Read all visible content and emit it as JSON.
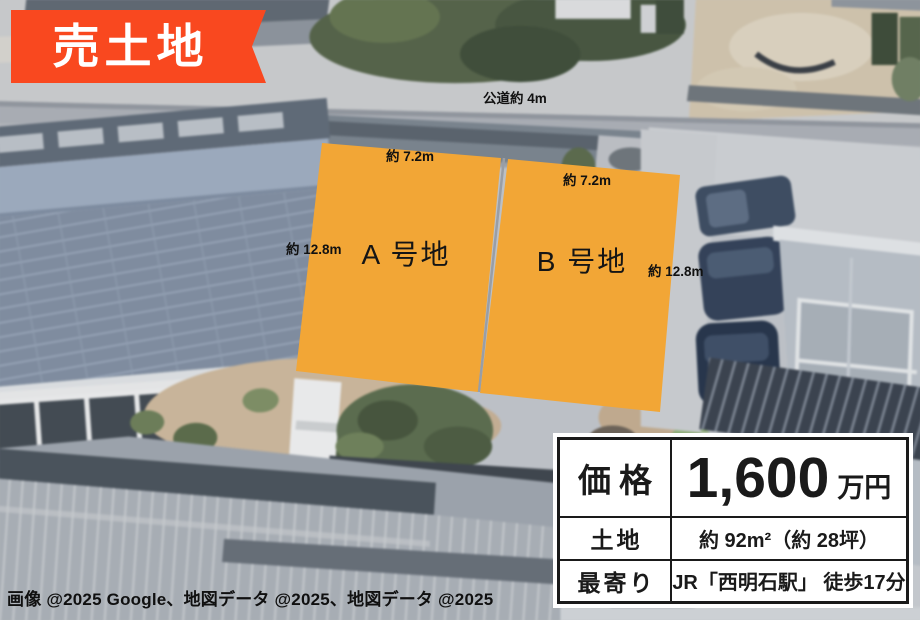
{
  "banner": {
    "label": "売土地"
  },
  "map": {
    "road_label": "公道約 4m",
    "parcels": [
      {
        "id": "A",
        "name": "A 号地",
        "width_label": "約 7.2m",
        "depth_label": "約 12.8m"
      },
      {
        "id": "B",
        "name": "B 号地",
        "width_label": "約 7.2m",
        "depth_label": "約 12.8m"
      }
    ],
    "attribution": "画像 @2025 Google、地図データ @2025、地図データ @2025"
  },
  "info_table": {
    "rows": [
      {
        "label": "価格",
        "value": "1,600",
        "unit": "万円"
      },
      {
        "label": "土地",
        "value": "約 92m²（約 28坪）"
      },
      {
        "label": "最寄り",
        "value": "JR「西明石駅」 徒歩17分"
      }
    ]
  },
  "colors": {
    "banner": "#F9481F",
    "parcel": "#F2A636",
    "parcel_divider": "#999EA6",
    "table_border": "#1A1A1A"
  }
}
